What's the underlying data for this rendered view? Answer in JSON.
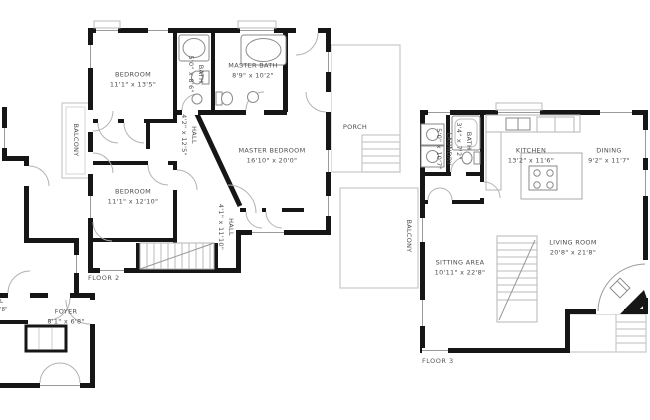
{
  "floors": {
    "floor1": {
      "rooms": {
        "foyer": {
          "name": "FOYER",
          "dims": "8'1\" x 6'8\""
        },
        "partial_room": {
          "line1": "L",
          "line2": "'8\""
        }
      }
    },
    "floor2": {
      "title": "FLOOR 2",
      "rooms": {
        "bedroom1": {
          "name": "BEDROOM",
          "dims": "11'1\" x 13'5\""
        },
        "bath": {
          "name": "BATH",
          "dims": "5'0\" x 8'6\""
        },
        "master_bath": {
          "name": "MASTER BATH",
          "dims": "8'9\" x 10'2\""
        },
        "master_bedroom": {
          "name": "MASTER BEDROOM",
          "dims": "16'10\" x 20'0\""
        },
        "bedroom2": {
          "name": "BEDROOM",
          "dims": "11'1\" x 12'10\""
        },
        "hall_upper": {
          "name": "HALL",
          "dims": "4'2\" x 12'5\""
        },
        "hall_lower": {
          "name": "HALL",
          "dims": "4'1\" x 11'10\""
        },
        "balcony": {
          "name": "BALCONY"
        },
        "porch": {
          "name": "PORCH"
        }
      }
    },
    "floor3": {
      "title": "FLOOR 3",
      "rooms": {
        "laundry": {
          "name": "LAUNDRY",
          "dims": "5'0\" x 10'7\""
        },
        "bath": {
          "name": "BATH",
          "dims": "3'4\" x 7'2\""
        },
        "kitchen": {
          "name": "KITCHEN",
          "dims": "13'2\" x 11'6\""
        },
        "dining": {
          "name": "DINING",
          "dims": "9'2\" x 11'7\""
        },
        "sitting_area": {
          "name": "SITTING AREA",
          "dims": "10'11\" x 22'8\""
        },
        "living_room": {
          "name": "LIVING ROOM",
          "dims": "20'8\" x 21'8\""
        },
        "balcony": {
          "name": "BALCONY"
        }
      }
    }
  },
  "colors": {
    "wall": "#161616",
    "light_outline": "#c9c9c9",
    "text": "#4d4d4d"
  }
}
